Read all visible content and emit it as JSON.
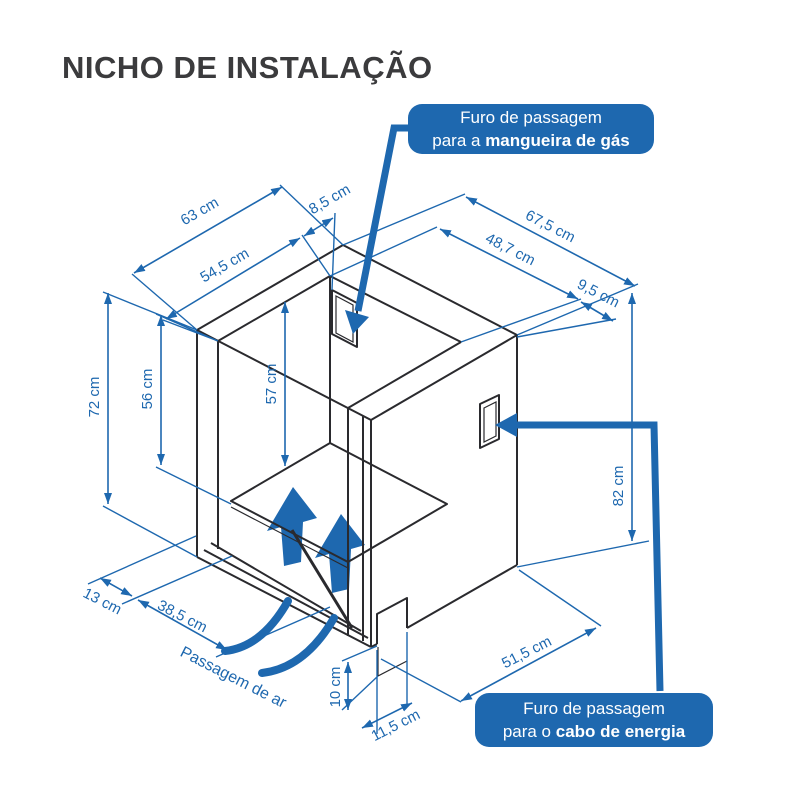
{
  "title": "NICHO DE INSTALAÇÃO",
  "colors": {
    "accent": "#1e68af",
    "line": "#2a2a2e",
    "title": "#3b3b3d"
  },
  "callouts": {
    "gas": {
      "line1": "Furo de passagem",
      "line2_normal": "para a ",
      "line2_bold": "mangueira de gás"
    },
    "power": {
      "line1": "Furo de passagem",
      "line2_normal": "para o ",
      "line2_bold": "cabo de energia"
    }
  },
  "air_flow_label": "Passagem de ar",
  "dimensions": [
    {
      "label": "63 cm",
      "line": [
        134,
        273,
        282,
        187
      ],
      "text": [
        200,
        212,
        -30
      ]
    },
    {
      "label": "54,5 cm",
      "line": [
        166,
        319,
        300,
        238
      ],
      "text": [
        225,
        266,
        -30
      ]
    },
    {
      "label": "8,5 cm",
      "line": [
        304,
        236,
        333,
        218
      ],
      "text": [
        330,
        200,
        -30
      ]
    },
    {
      "label": "67,5 cm",
      "line": [
        466,
        197,
        635,
        286
      ],
      "text": [
        550,
        227,
        27
      ]
    },
    {
      "label": "48,7 cm",
      "line": [
        440,
        229,
        578,
        299
      ],
      "text": [
        510,
        250,
        27
      ]
    },
    {
      "label": "9,5 cm",
      "line": [
        581,
        302,
        613,
        321
      ],
      "text": [
        598,
        294,
        27
      ]
    },
    {
      "label": "72 cm",
      "line": [
        108,
        293,
        108,
        504
      ],
      "text": [
        95,
        397,
        -90
      ]
    },
    {
      "label": "56 cm",
      "line": [
        161,
        315,
        161,
        465
      ],
      "text": [
        148,
        389,
        -90
      ]
    },
    {
      "label": "57 cm",
      "line": [
        285,
        302,
        285,
        466
      ],
      "text": [
        272,
        384,
        -90
      ]
    },
    {
      "label": "82 cm",
      "line": [
        632,
        293,
        632,
        541
      ],
      "text": [
        619,
        486,
        -90
      ]
    },
    {
      "label": "13 cm",
      "line": [
        100,
        578,
        132,
        596
      ],
      "text": [
        102,
        602,
        27
      ]
    },
    {
      "label": "38,5 cm",
      "line": [
        138,
        600,
        227,
        650
      ],
      "text": [
        182,
        617,
        27
      ]
    },
    {
      "label": "51,5 cm",
      "line": [
        461,
        701,
        596,
        628
      ],
      "text": [
        527,
        653,
        -27
      ]
    },
    {
      "label": "10 cm",
      "line": [
        348,
        662,
        348,
        710
      ],
      "text": [
        336,
        687,
        -90
      ]
    },
    {
      "label": "11,5 cm",
      "line": [
        362,
        728,
        412,
        703
      ],
      "text": [
        396,
        726,
        -27
      ]
    }
  ],
  "air_label_pos": {
    "text": [
      233,
      678,
      27
    ]
  }
}
